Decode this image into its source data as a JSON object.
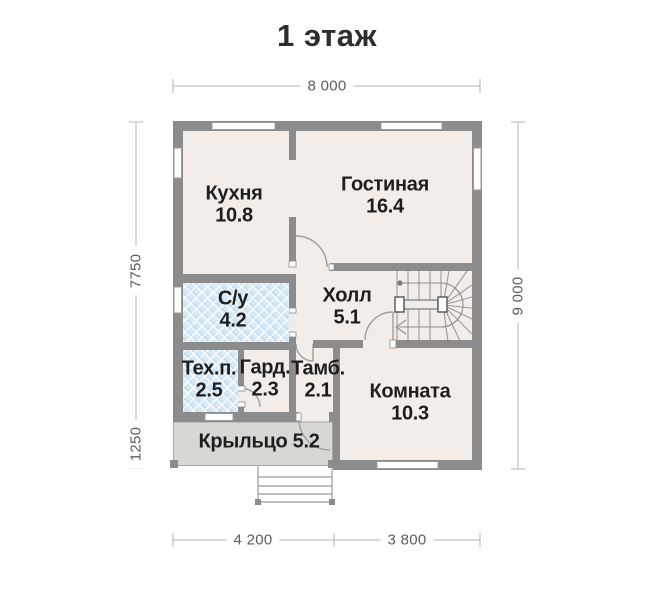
{
  "title": "1 этаж",
  "rooms": [
    {
      "name": "Кухня",
      "area": "10.8"
    },
    {
      "name": "Гостиная",
      "area": "16.4"
    },
    {
      "name": "С/у",
      "area": "4.2"
    },
    {
      "name": "Холл",
      "area": "5.1"
    },
    {
      "name": "Тех.п.",
      "area": "2.5"
    },
    {
      "name": "Гард.",
      "area": "2.3"
    },
    {
      "name": "Тамб.",
      "area": "2.1"
    },
    {
      "name": "Комната",
      "area": "10.3"
    },
    {
      "name": "Крыльцо",
      "area": "5.2"
    }
  ],
  "dimensions": {
    "top": "8 000",
    "left_upper": "7750",
    "left_lower": "1250",
    "right": "9 000",
    "bottom_left": "4 200",
    "bottom_right": "3 800"
  },
  "colors": {
    "wall": "#8c8c8c",
    "floor": "#f2ede9",
    "wet_room": "#d7e9f6",
    "porch": "#d9d7d4",
    "dimension_line": "#b3b3b3",
    "text": "#1e1e1e"
  }
}
